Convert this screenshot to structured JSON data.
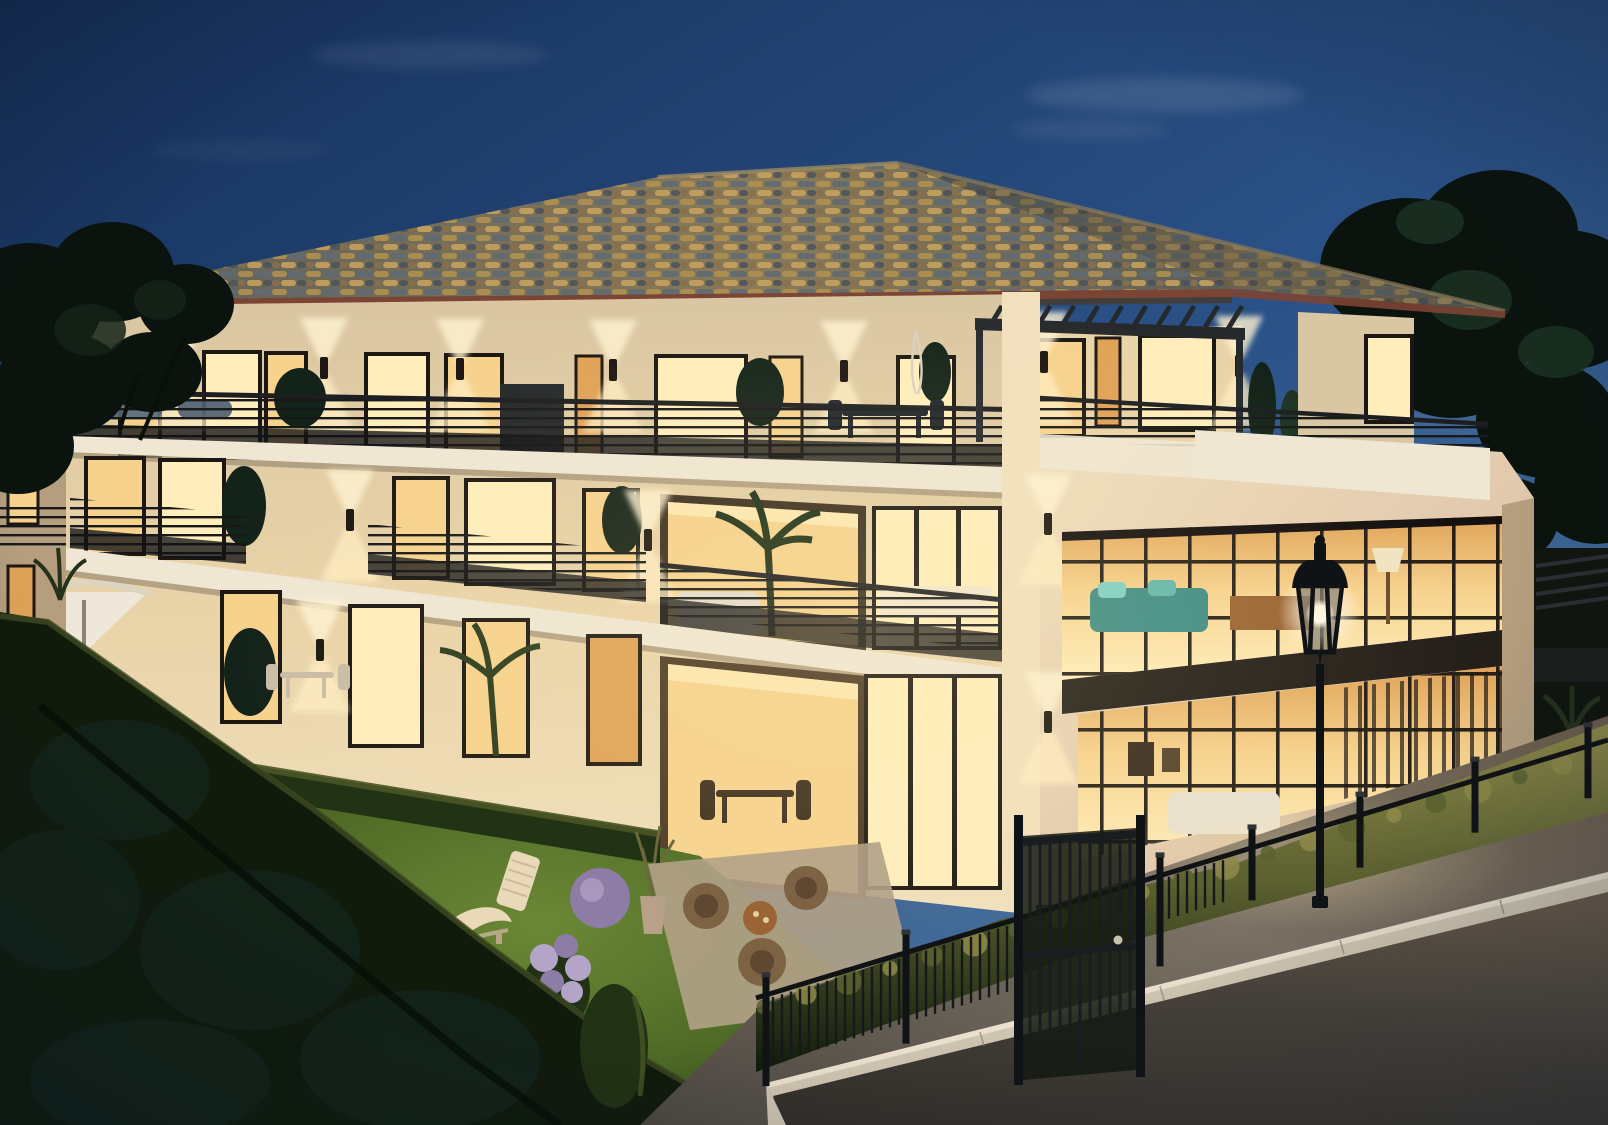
{
  "scene": {
    "type": "architectural-rendering",
    "time_of_day": "dusk",
    "subject": "Modern three-storey cream apartment residence at dusk with mottled tile hip roof, warmly lit floor-to-ceiling windows, terraces and balconies with dark wire railings, roof terrace with pergola and parasol, front garden with lawn loungers and flowering shrubs, clipped hedges, black bar fence with pedestrian gate, classic black street lantern and a curving asphalt street with pale curb"
  },
  "lighting": {
    "sky": "deep blue twilight gradient, brighter toward the right horizon",
    "interior": "warm amber glow from every window",
    "fixtures": "up/down wall sconces on facades, glowing white globe in street lantern",
    "ground": "warm light pools on sidewalk, hedge tops and lawn"
  },
  "building": {
    "storeys": 3,
    "roof": "hipped, mottled tan/grey barrel tiles, terracotta eave trim",
    "top_floor": {
      "windows": 9,
      "attic_windows": 4,
      "wall_sconces": 6,
      "terrace": "full-width with wire railing, parasol, loungers, pergola at right, dining set, plants"
    },
    "middle_floor": {
      "windows": 5,
      "balconies": 2,
      "corner_loggia": "open with palm and sofa",
      "bedroom_bay": 1
    },
    "ground_floor": {
      "windows": 4,
      "terraces": 2,
      "corner_loggia_doors": 1,
      "umbrella": "white parasol with bistro set"
    },
    "right_wing": {
      "glazed_bays": "two-storey black-mullion industrial glazing",
      "spandrel": "dark band between floors",
      "interior_hints": "teal sofa, wood dining table, floor lamps, white sofa"
    }
  },
  "garden": {
    "lawn": "lit green lawn",
    "furniture": [
      "white wave chaise longue",
      "slatted sun lounger",
      "wicker armchairs with round table"
    ],
    "plants": [
      "purple hydrangea bush",
      "lilac ball shrub",
      "white flower patch",
      "potted grasses",
      "clipped box hedges"
    ]
  },
  "street": {
    "fence": "black vertical-bar fence with posts over a lit hedge",
    "gate": "black pedestrian gate",
    "lantern": "classic black park lantern with white globe",
    "surface": [
      "warm-lit concrete sidewalk",
      "pale stone curb turning a corner",
      "dark asphalt roadway"
    ]
  },
  "colors": {
    "sky_top": "#152f58",
    "sky_mid": "#2b5288",
    "sky_bright": "#4e7aa6",
    "cloud": "#cfdbe8",
    "roof_dark": "#5c5f58",
    "roof_warm": "#8a7a58",
    "tile_tan": "#b3924f",
    "tile_amber": "#caa45e",
    "tile_grey": "#5e6a74",
    "tile_slate": "#49525c",
    "tile_brown": "#8a6f4a",
    "eave_trim": "#7c4433",
    "soffit_lit": "#e8d3a4",
    "wall_lit": "#f0e0bd",
    "wall_warm": "#e9d3a8",
    "wall_mid": "#d9c6a2",
    "wall_shadow": "#b49e7e",
    "wall_pink": "#e2c9ae",
    "slab_lit": "#efe7d4",
    "slab_shade": "#cfc3ab",
    "glow_bright": "#ffeebc",
    "glow_mid": "#f6d28d",
    "glow_deep": "#dfa257",
    "glow_core": "#fff6d8",
    "frame_dark": "#1c1713",
    "railing": "#17181a",
    "mesh": "#121316",
    "deck": "#31281e",
    "metal": "#26292c",
    "teal": "#3f8d85",
    "wood": "#9a6434",
    "tree_dark": "#0a130d",
    "tree_mid": "#142319",
    "tree_soft": "#1d3424",
    "hedge_dark": "#101b0c",
    "hedge_mid": "#223214",
    "hedge_lit": "#5c6130",
    "hedge_gold": "#8d8a4a",
    "lawn_bright": "#6b8836",
    "lawn": "#4f6b26",
    "lawn_dark": "#2c421a",
    "flower_purple": "#8d7ca6",
    "flower_lilac": "#b4a4c8",
    "flower_white": "#d8d4c2",
    "lounger": "#ead9b8",
    "wicker": "#7d6243",
    "paving": "#b2a288",
    "road_dark": "#332f2a",
    "road_mid": "#4a443c",
    "road_warm": "#6a5c4c",
    "sidewalk": "#7b7265",
    "sidewalk_dark": "#4e4942",
    "curb": "#d2c8b4",
    "curb_shade": "#9e9484",
    "lamp_black": "#101316",
    "glow_white": "#fdf6e3"
  }
}
